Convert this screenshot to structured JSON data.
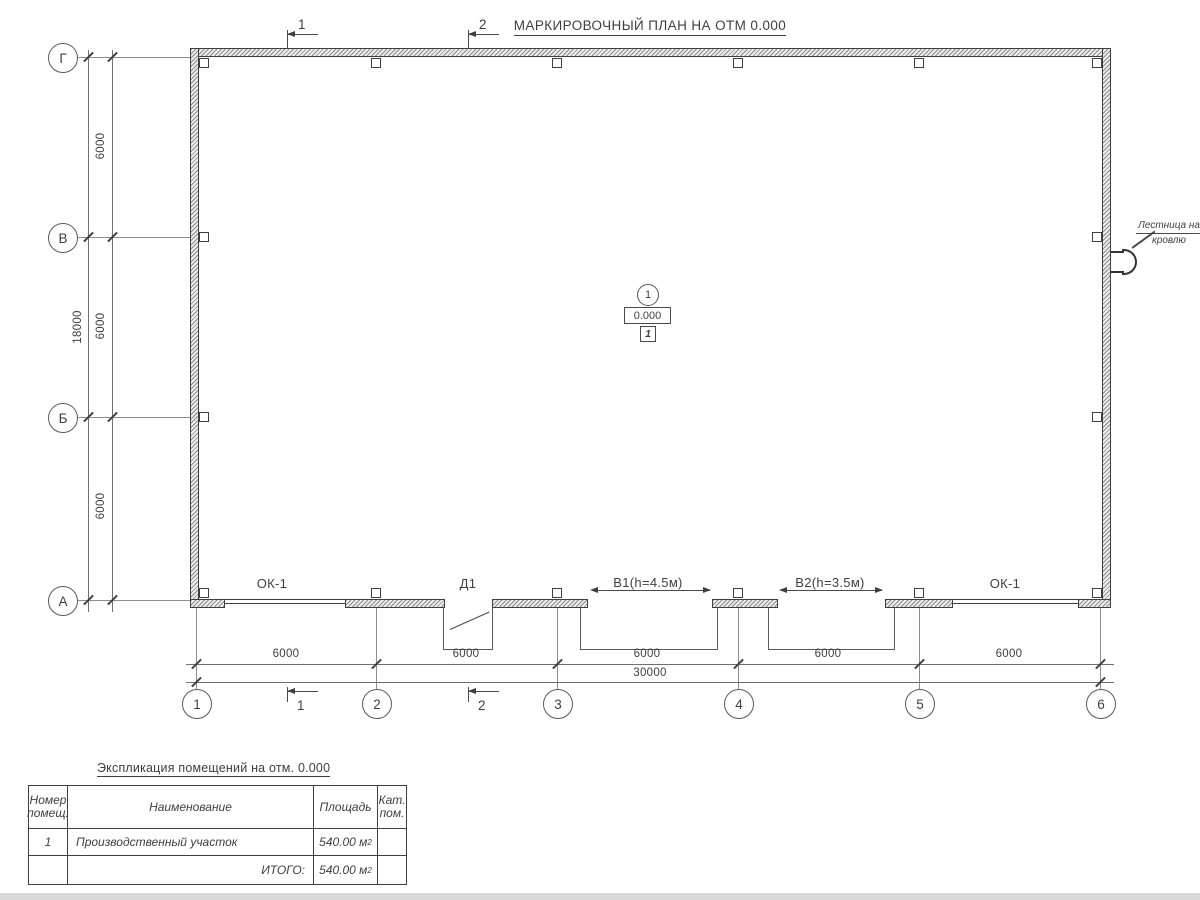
{
  "title": "МАРКИРОВОЧНЫЙ ПЛАН НА ОТМ 0.000",
  "axes": {
    "rows": [
      {
        "label": "Г"
      },
      {
        "label": "В"
      },
      {
        "label": "Б"
      },
      {
        "label": "А"
      }
    ],
    "cols": [
      {
        "label": "1"
      },
      {
        "label": "2"
      },
      {
        "label": "3"
      },
      {
        "label": "4"
      },
      {
        "label": "5"
      },
      {
        "label": "6"
      }
    ]
  },
  "dims": {
    "left_segments": [
      "6000",
      "6000",
      "6000"
    ],
    "left_total": "18000",
    "bottom_segments": [
      "6000",
      "6000",
      "6000",
      "6000",
      "6000"
    ],
    "bottom_total": "30000"
  },
  "sections": {
    "one": "1",
    "two": "2"
  },
  "room_marker": {
    "number": "1",
    "elevation": "0.000",
    "zone": "1"
  },
  "ladder": {
    "line1": "Лестница на",
    "line2": "кровлю"
  },
  "openings": {
    "window_left": "ОК-1",
    "door": "Д1",
    "gate1": "В1(h=4.5м)",
    "gate2": "В2(h=3.5м)",
    "window_right": "ОК-1"
  },
  "table": {
    "title": "Экспликация помещений на отм. 0.000",
    "headers": [
      "Номер помещ.",
      "Наименование",
      "Площадь",
      "Кат. пом."
    ],
    "rows": [
      {
        "num": "1",
        "name": "Производственный участок",
        "area": "540.00 м",
        "area_sup": "2",
        "cat": ""
      }
    ],
    "total_label": "ИТОГО:",
    "total_area": "540.00 м",
    "total_sup": "2"
  },
  "colors": {
    "line": "#3f3f3f",
    "thin_line": "#8f8f8f",
    "wall_fill": "#ececec",
    "bottom_bar": "#d9d9d9",
    "background": "#ffffff"
  }
}
